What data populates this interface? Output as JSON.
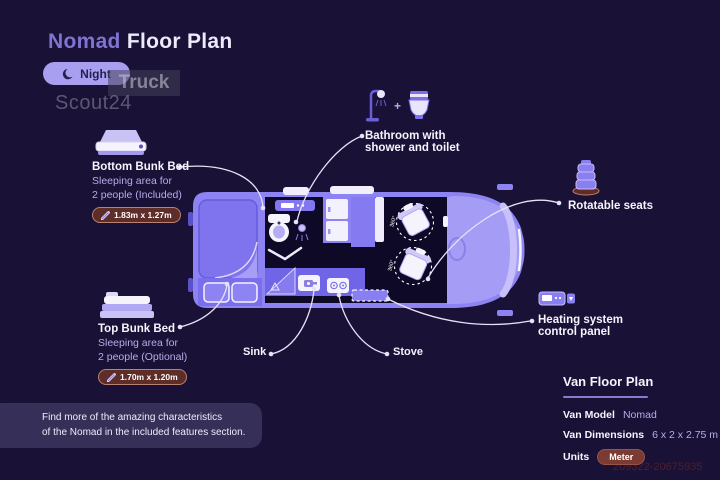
{
  "title": {
    "model": "Nomad",
    "rest": "Floor Plan"
  },
  "mode_toggle": {
    "label": "Night"
  },
  "watermark": {
    "line1": "Truck",
    "line2": "Scout24"
  },
  "annotations": {
    "bottom_bunk": {
      "title": "Bottom Bunk Bed",
      "desc1": "Sleeping area for",
      "desc2": "2 people (Included)",
      "dimensions": "1.83m x 1.27m"
    },
    "top_bunk": {
      "title": "Top Bunk Bed",
      "desc1": "Sleeping area for",
      "desc2": "2 people (Optional)",
      "dimensions": "1.70m x 1.20m"
    },
    "bathroom": {
      "line1": "Bathroom with",
      "line2": "shower and toilet",
      "plus": "+"
    },
    "rotatable_seats": {
      "label": "Rotatable seats"
    },
    "heating": {
      "line1": "Heating system",
      "line2": "control panel"
    },
    "sink": {
      "label": "Sink"
    },
    "stove": {
      "label": "Stove"
    }
  },
  "floorplan": {
    "seat_rotation": "360°"
  },
  "info_panel": {
    "title": "Van Floor Plan",
    "rows": [
      {
        "label": "Van Model",
        "value": "Nomad"
      },
      {
        "label": "Van Dimensions",
        "value": "6 x 2 x 2.75 m"
      }
    ],
    "units_label": "Units",
    "units_value": "Meter"
  },
  "footer_note": {
    "line1": "Find more of the amazing characteristics",
    "line2": "of the Nomad in the included features section."
  },
  "listing_id": "209322-20675935",
  "colors": {
    "background": "#1a1136",
    "van_body": "#8d83f2",
    "dark_interior": "#0d0926",
    "accent_text": "#b6adeb",
    "badge_brown": "#5f2d27",
    "toggle_lavender": "#a89ff1",
    "units_pill": "#7c3b32",
    "leader_line": "#e6e2f8"
  }
}
